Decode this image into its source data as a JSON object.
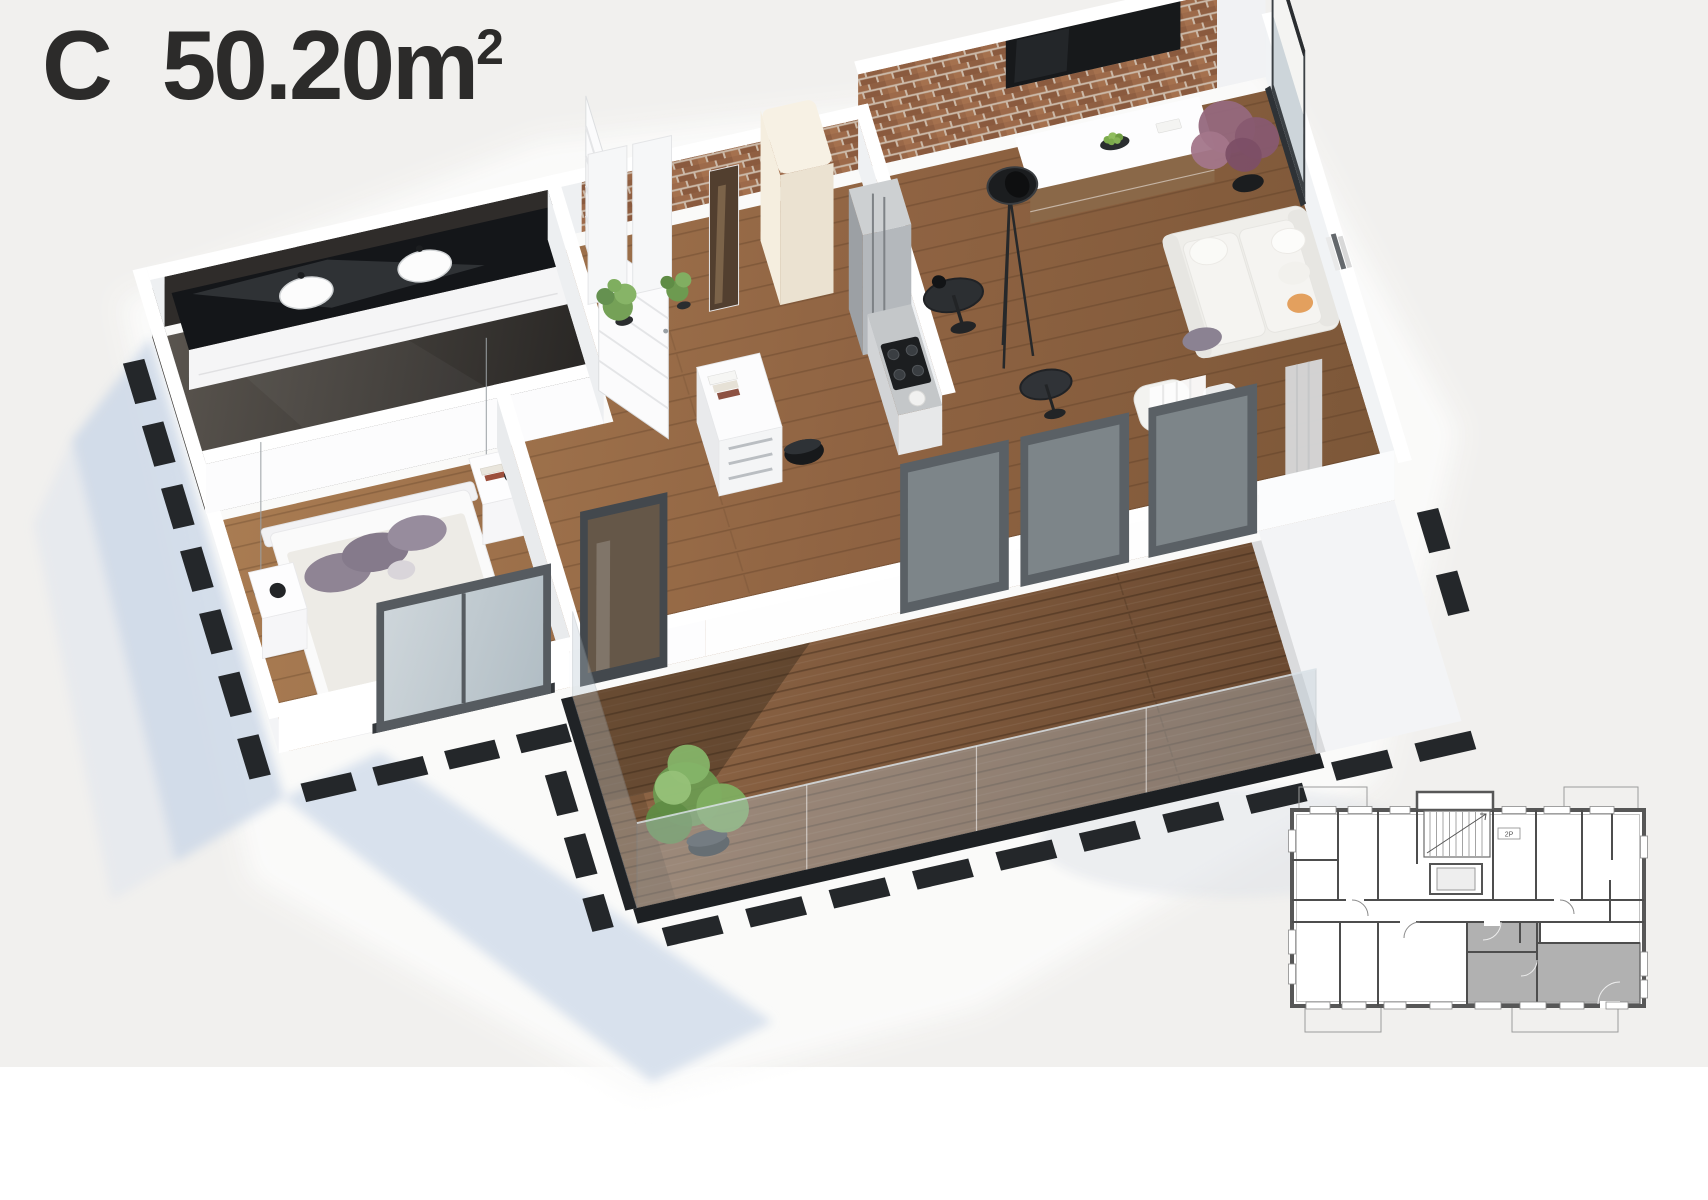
{
  "header": {
    "unit_letter": "C",
    "area_value": "50.20",
    "area_unit": "m",
    "area_exponent": "2"
  },
  "mini_plan": {
    "stair_label": "2P",
    "highlight_color": "#a9a9a9",
    "line_color": "#4f4f4f"
  },
  "palette": {
    "background": "#f1f0ee",
    "lower_background": "#ffffff",
    "title_text": "#2c2b2a",
    "wood_floor": "#9a6d46",
    "deck_wood": "#7d5a3c",
    "brick": "#9a6a4c",
    "bathroom_dark": "#2b2927",
    "wall_white": "#ffffff",
    "wall_shade": "#eceef0",
    "frame_dark": "#4b5055",
    "glass": "#b6c4cd",
    "shadow_blue": "#cddaea",
    "orange_pillow": "#e5a058",
    "plant_green": "#7fae4e",
    "plant_purple": "#96687e",
    "black_furniture": "#1d1f21"
  }
}
